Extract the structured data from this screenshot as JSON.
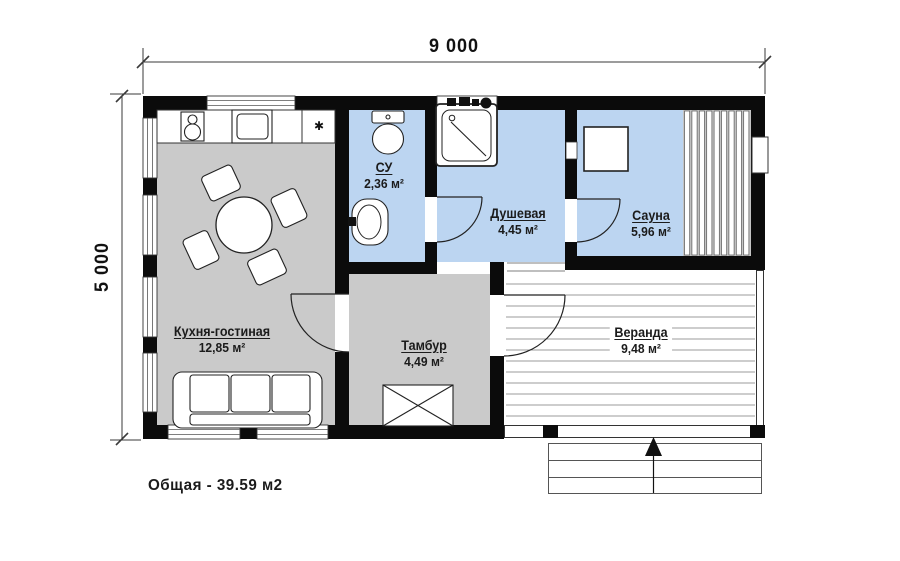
{
  "plan": {
    "dimension_width": "9 000",
    "dimension_height": "5 000",
    "total_area": "Общая - 39.59 м2",
    "rooms": [
      {
        "name": "Кухня-гостиная",
        "area": "12,85 м²"
      },
      {
        "name": "СУ",
        "area": "2,36 м²"
      },
      {
        "name": "Душевая",
        "area": "4,45 м²"
      },
      {
        "name": "Сауна",
        "area": "5,96 м²"
      },
      {
        "name": "Тамбур",
        "area": "4,49 м²"
      },
      {
        "name": "Веранда",
        "area": "9,48 м²"
      }
    ],
    "symbols": {
      "utility_mark": "✱"
    },
    "colors": {
      "wet_room_fill": "#bcd5f1",
      "dry_room_fill": "#cacaca",
      "wall": "#0b0b0b",
      "deck_line": "#9b9b9b"
    }
  }
}
